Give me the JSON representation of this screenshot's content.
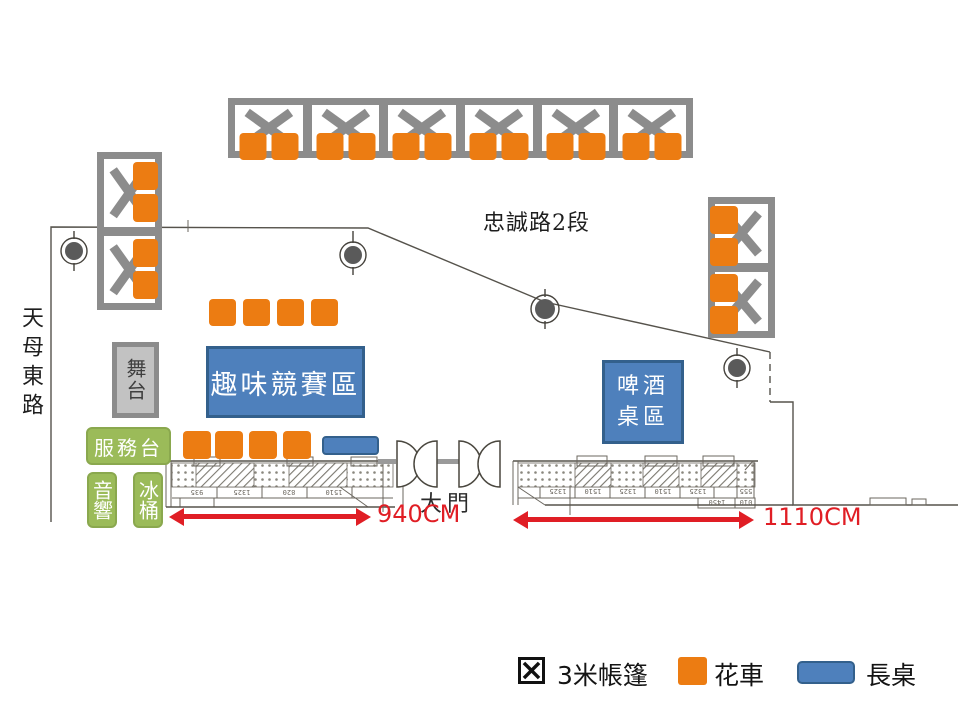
{
  "roads": {
    "top": "忠誠路2段",
    "left": "天母東路"
  },
  "areas": {
    "stage": "舞台",
    "service_desk": "服務台",
    "audio": "音響",
    "ice_bucket": "冰桶",
    "game_zone": "趣味競賽區",
    "beer_zone_line1": "啤酒",
    "beer_zone_line2": "桌區",
    "main_gate": "大門"
  },
  "measurements": {
    "left_width": "940CM",
    "right_width": "1110CM"
  },
  "legend": {
    "tent": "3米帳篷",
    "flower_cart": "花車",
    "long_table": "長桌"
  },
  "plan_numbers": [
    "935",
    "1325",
    "820",
    "1510",
    "1325",
    "1510",
    "1325",
    "1510",
    "1325",
    "555",
    "1450",
    "010"
  ],
  "colors": {
    "orange": "#EC7C12",
    "blue_fill": "#4E80BC",
    "blue_border": "#33608C",
    "green": "#9BBB59",
    "green_border": "#8AA84E",
    "gray_tent": "#8C8C8C",
    "stage_fill": "#C2C2C2",
    "red": "#E01E25",
    "plan_line": "#56534C"
  }
}
